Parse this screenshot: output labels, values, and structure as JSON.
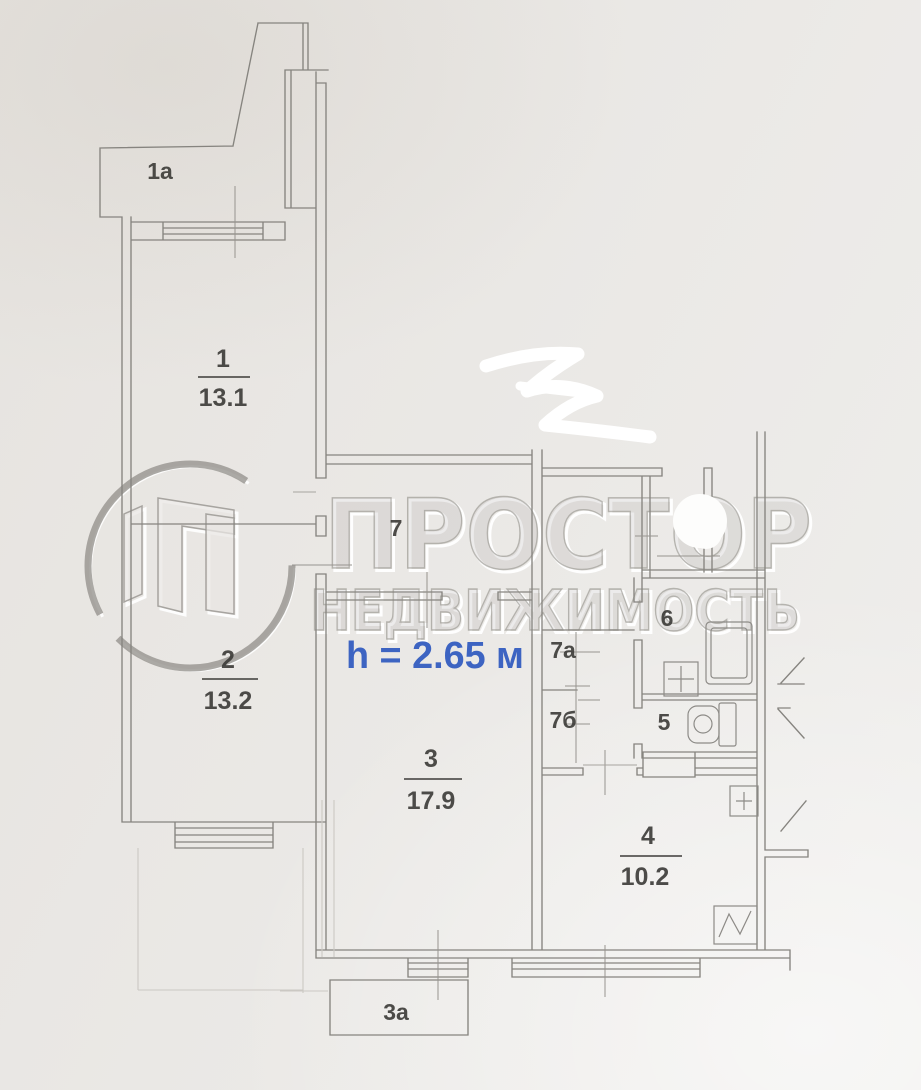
{
  "watermark": {
    "brand": "ПРОСТОР",
    "tagline": "НЕДВИЖИМОСТЬ"
  },
  "annotation": {
    "ceiling_height": "h = 2.65 м"
  },
  "rooms": {
    "balcony_1a": {
      "label": "1а"
    },
    "room_1": {
      "number": "1",
      "area": "13.1"
    },
    "room_2": {
      "number": "2",
      "area": "13.2"
    },
    "room_3": {
      "number": "3",
      "area": "17.9"
    },
    "kitchen_4": {
      "number": "4",
      "area": "10.2"
    },
    "wc_5": {
      "label": "5"
    },
    "bath_6": {
      "label": "6"
    },
    "hall_7": {
      "label": "7"
    },
    "hall_7a": {
      "label": "7а"
    },
    "hall_7b": {
      "label": "7б"
    },
    "balcony_3a": {
      "label": "3а"
    }
  },
  "colors": {
    "paper": "#eae8e5",
    "ink": "#3b3a37",
    "wall": "#86847f",
    "accent_blue": "#3d64c2",
    "watermark": "#a9a7a3"
  }
}
